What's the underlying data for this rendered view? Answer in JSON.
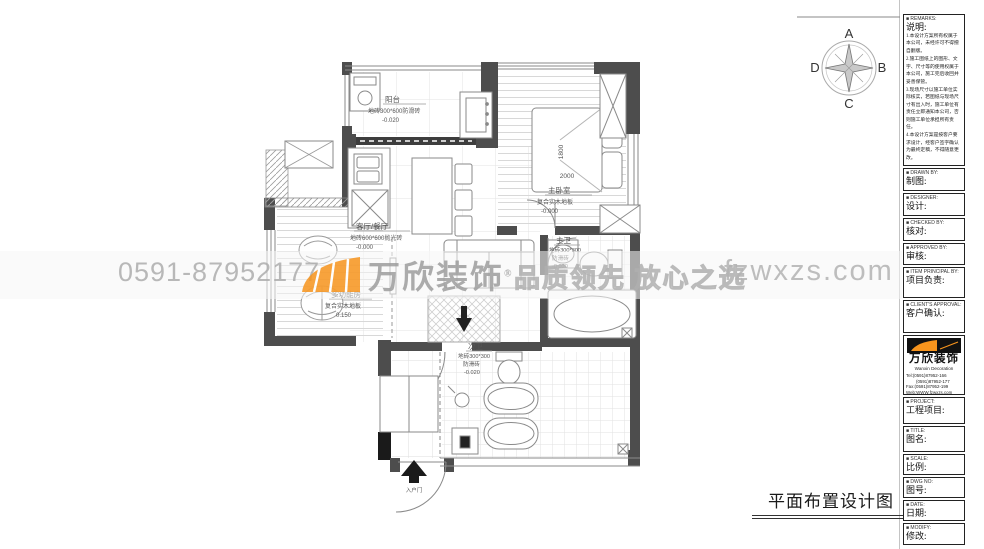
{
  "sheet_title": "平面布置设计图",
  "watermark": {
    "phone": "0591-87952177",
    "brand": "万欣装饰",
    "reg": "®",
    "tagline": "品质领先 放心之选",
    "website": "fzwxzs.com"
  },
  "compass": {
    "n": "A",
    "e": "B",
    "s": "C",
    "w": "D"
  },
  "plan": {
    "rooms": {
      "balcony": {
        "name": "阳台",
        "floor": "地砖300*600防滑砖",
        "level": "-0.020"
      },
      "master_bedroom": {
        "name": "主卧室",
        "floor": "复合实木地板",
        "level": "-0.000"
      },
      "living_dining": {
        "name": "客厅/餐厅",
        "floor": "地砖600*600抛光砖",
        "level": "-0.000"
      },
      "multi_room": {
        "name": "多功能房",
        "floor": "复合实木地板",
        "level": "0.150"
      },
      "master_bath": {
        "name": "主卫",
        "floor": "地砖300*300",
        "floor2": "防滑砖",
        "level": "-0.020"
      },
      "second_bath": {
        "name": "次卫",
        "floor": "地砖300*300",
        "floor2": "防滑砖",
        "level": "-0.020"
      }
    },
    "dimensions": {
      "bed_width": "1800",
      "bed_length": "2000"
    },
    "entry_label": "入户门"
  },
  "title_block": {
    "remarks": {
      "header": "■ REMARKS:",
      "label": "说明:",
      "notes": [
        "1.本设计方案所有权属于本公司，未经许可不得擅自翻版。",
        "2.施工图纸上的图形、文字、尺寸等的使用权属于本公司，施工完后收回并妥善保管。",
        "3.现场尺寸以施工单位实际核实，若图纸与现场尺寸有出入时，施工单位有责任立即通知本公司，否则施工单位承担所有责任。",
        "4.本设计方案是按客户要求设计，经客户签字确认为最终定稿，不得随意更改。"
      ]
    },
    "drawn": {
      "header": "■ DRAWN BY:",
      "label": "制图:"
    },
    "designer": {
      "header": "■ DESIGNER:",
      "label": "设计:"
    },
    "checked": {
      "header": "■ CHECKED BY:",
      "label": "核对:"
    },
    "approved": {
      "header": "■ APPROVED BY:",
      "label": "审核:"
    },
    "principal": {
      "header": "■ ITEM PRINCIPAL BY:",
      "label": "项目负责:"
    },
    "client": {
      "header": "■ CLIENT'S APPROVAL:",
      "label": "客户确认:"
    },
    "company": {
      "name": "万欣装饰",
      "name_en": "Wanxin Decoration",
      "tel1": "Tel:(0591)87952-166",
      "tel2": "(0591)87952-177",
      "fax": "Fax:(0591)87952-199",
      "web": "Web:WWW.fzwxzs.com"
    },
    "project": {
      "header": "■ PROJECT:",
      "label": "工程项目:"
    },
    "title": {
      "header": "■ TITLE:",
      "label": "图名:"
    },
    "scale": {
      "header": "■ SCALE:",
      "label": "比例:"
    },
    "dwg": {
      "header": "■ DWG NO:",
      "label": "图号:"
    },
    "date": {
      "header": "■ DATE:",
      "label": "日期:"
    },
    "modify": {
      "header": "■ MODIFY:",
      "label": "修改:"
    }
  }
}
